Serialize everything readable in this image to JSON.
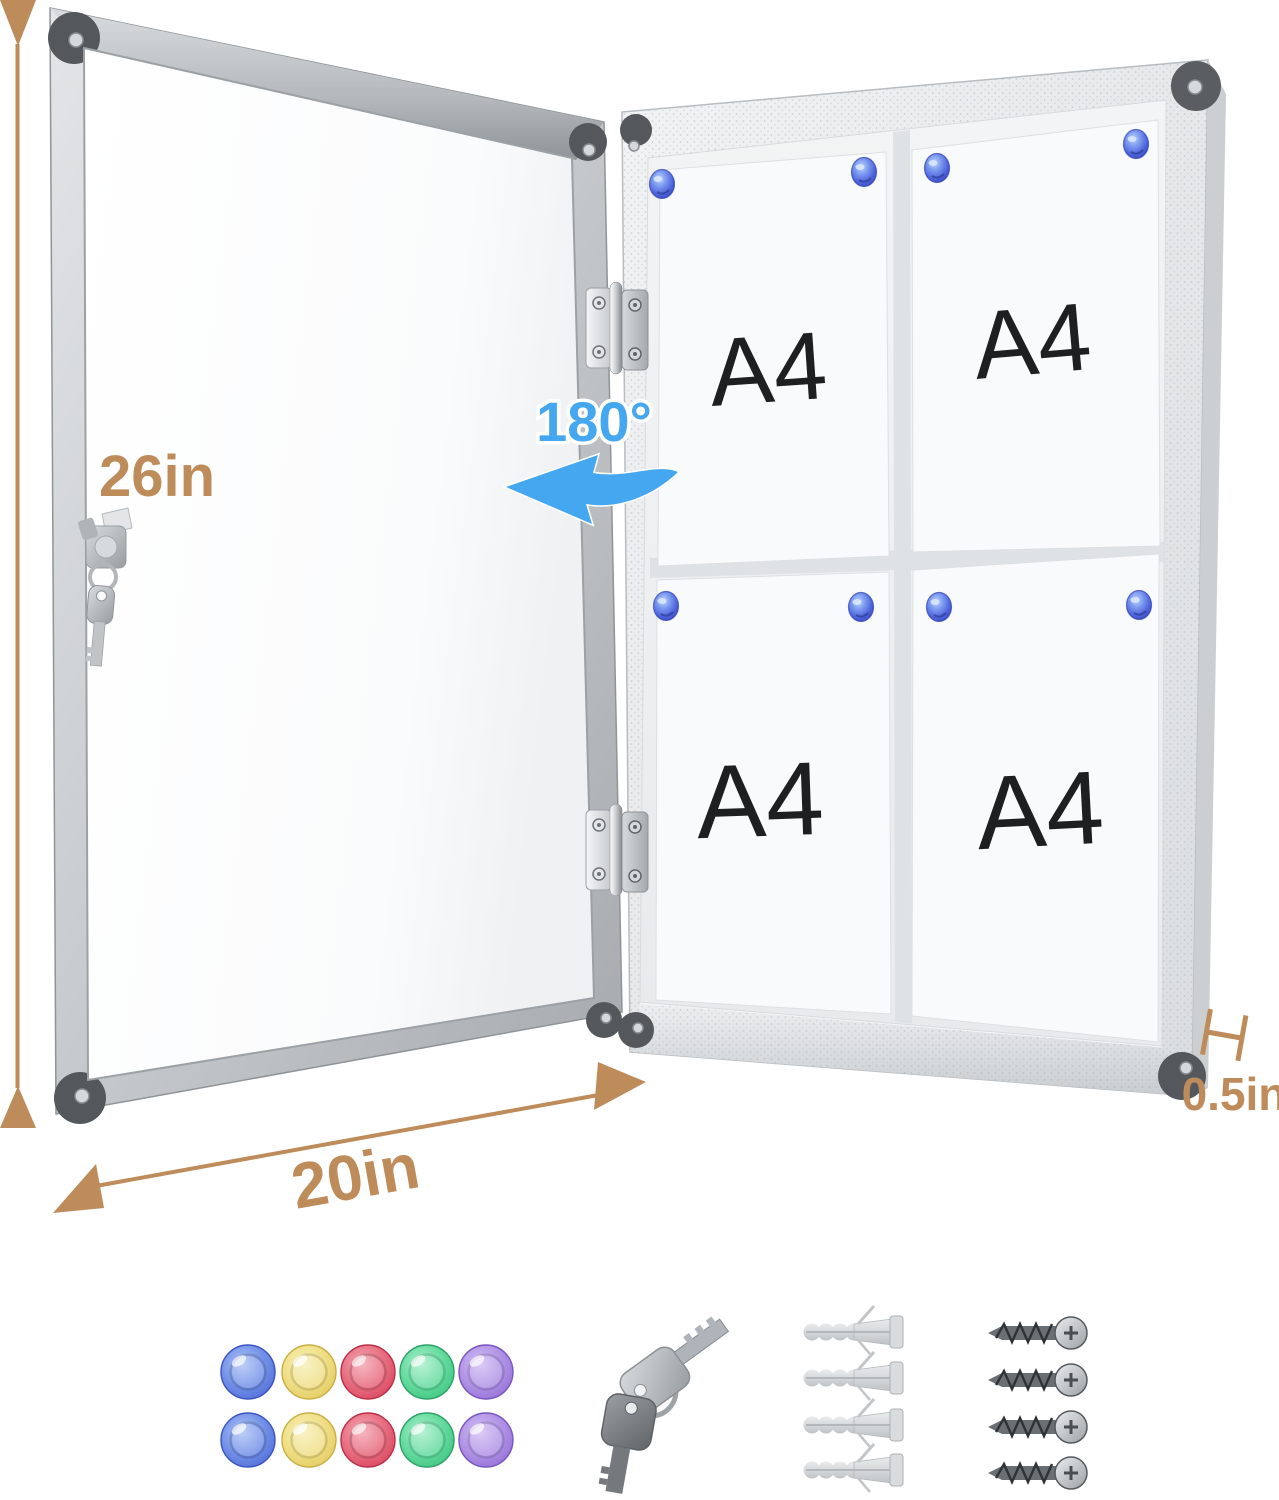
{
  "annotations": {
    "height_label": "26in",
    "width_label": "20in",
    "depth_label": "0.5in",
    "swing_angle_label": "180°",
    "dimension_color": "#BE8C5A",
    "angle_color": "#45A7F0"
  },
  "board": {
    "papers": [
      {
        "label": "A4"
      },
      {
        "label": "A4"
      },
      {
        "label": "A4"
      },
      {
        "label": "A4"
      }
    ],
    "magnet_color": "#4E6BDF",
    "magnets_per_paper": 2
  },
  "accessories": {
    "round_magnets": {
      "count": 10,
      "rows": 2,
      "colors": [
        "#5B82E0",
        "#EBD878",
        "#DE5670",
        "#4FCD8C",
        "#A283DD"
      ]
    },
    "keys": {
      "count": 2
    },
    "wall_anchors": {
      "count": 4
    },
    "screws": {
      "count": 4
    }
  }
}
